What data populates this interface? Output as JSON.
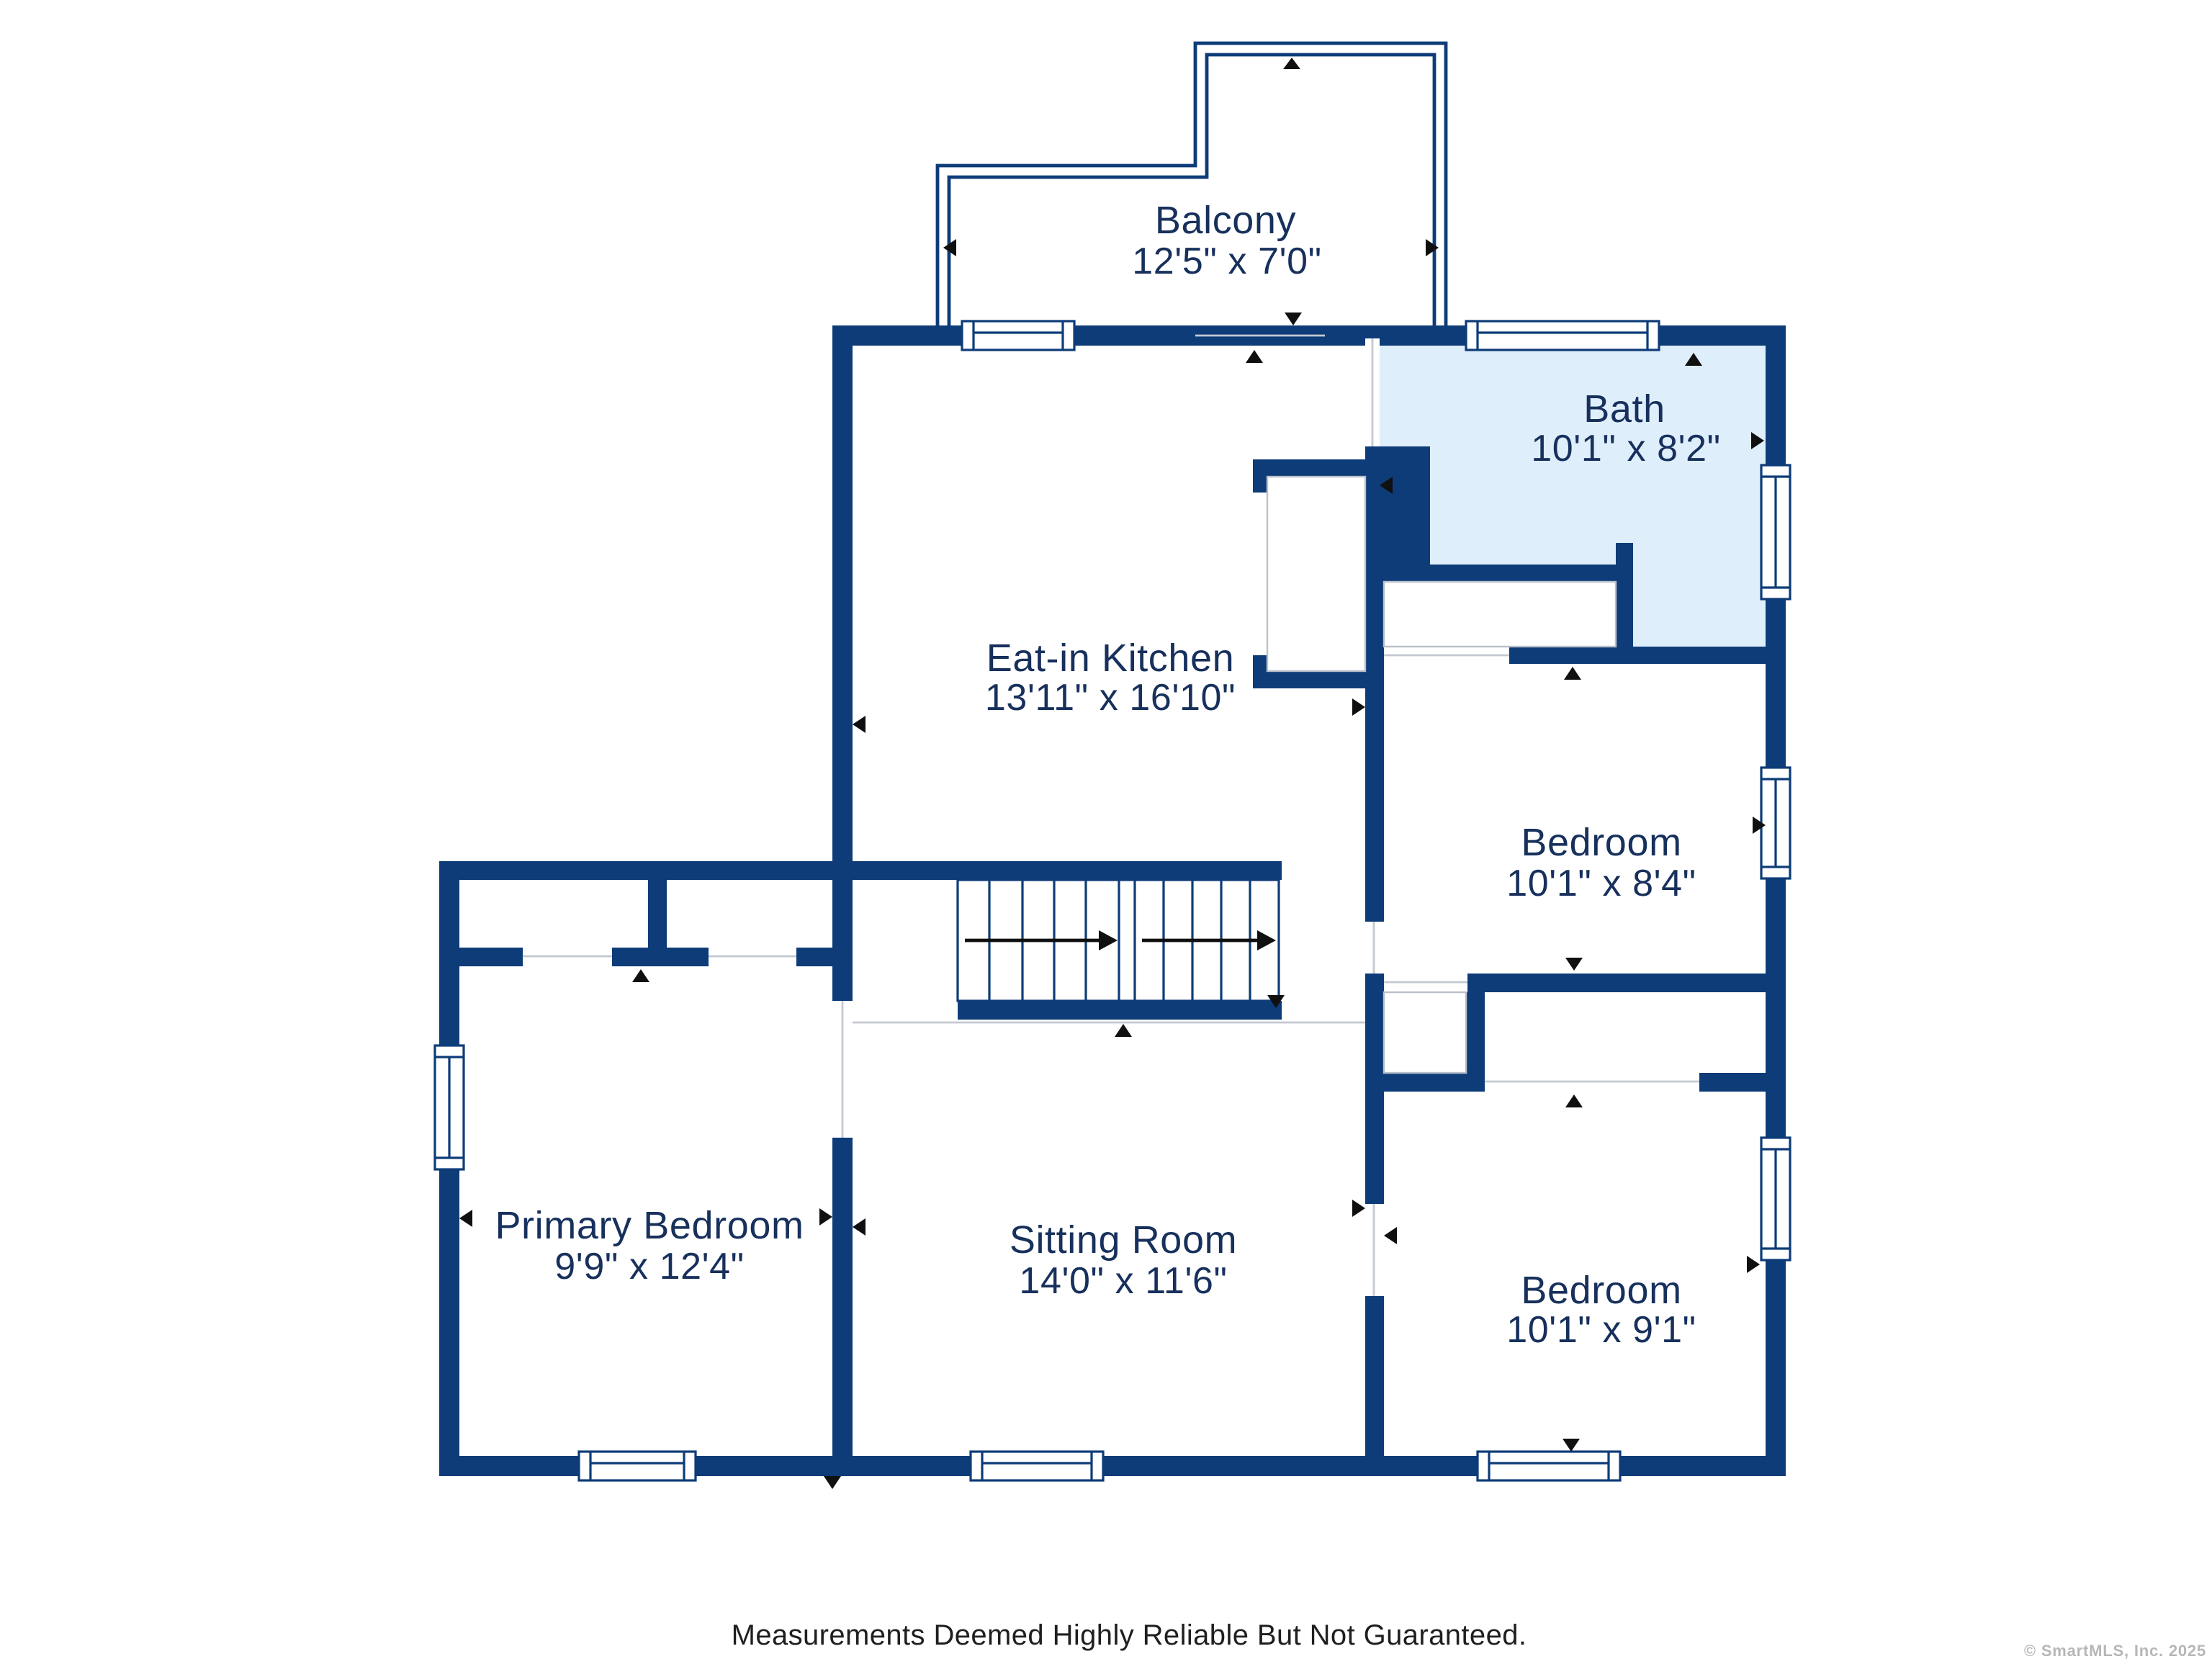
{
  "plan": {
    "title": "Second floor plan",
    "rooms": [
      {
        "id": "balcony",
        "name": "Balcony",
        "dims": "12'5\" x 7'0\""
      },
      {
        "id": "kitchen",
        "name": "Eat-in Kitchen",
        "dims": "13'11\" x 16'10\""
      },
      {
        "id": "bath",
        "name": "Bath",
        "dims": "10'1\" x 8'2\""
      },
      {
        "id": "bedroom-top",
        "name": "Bedroom",
        "dims": "10'1\" x 8'4\""
      },
      {
        "id": "primary-bedroom",
        "name": "Primary Bedroom",
        "dims": "9'9\" x 12'4\""
      },
      {
        "id": "sitting-room",
        "name": "Sitting Room",
        "dims": "14'0\" x 11'6\""
      },
      {
        "id": "bedroom-bottom",
        "name": "Bedroom",
        "dims": "10'1\" x 9'1\""
      }
    ],
    "colors": {
      "wall": "#0d3c78",
      "bath_fill": "#dfeefb",
      "label_text": "#17305c",
      "footer_text": "#1f1f1f",
      "copyright_text": "#b7b7b7"
    },
    "icons": [
      "measure-arrow-icon",
      "stairs-direction-arrow-icon",
      "window-symbol",
      "door-opening-line"
    ]
  },
  "footer": {
    "disclaimer": "Measurements Deemed Highly Reliable But Not Guaranteed."
  },
  "watermark": {
    "copyright": "© SmartMLS, Inc.  2025"
  }
}
